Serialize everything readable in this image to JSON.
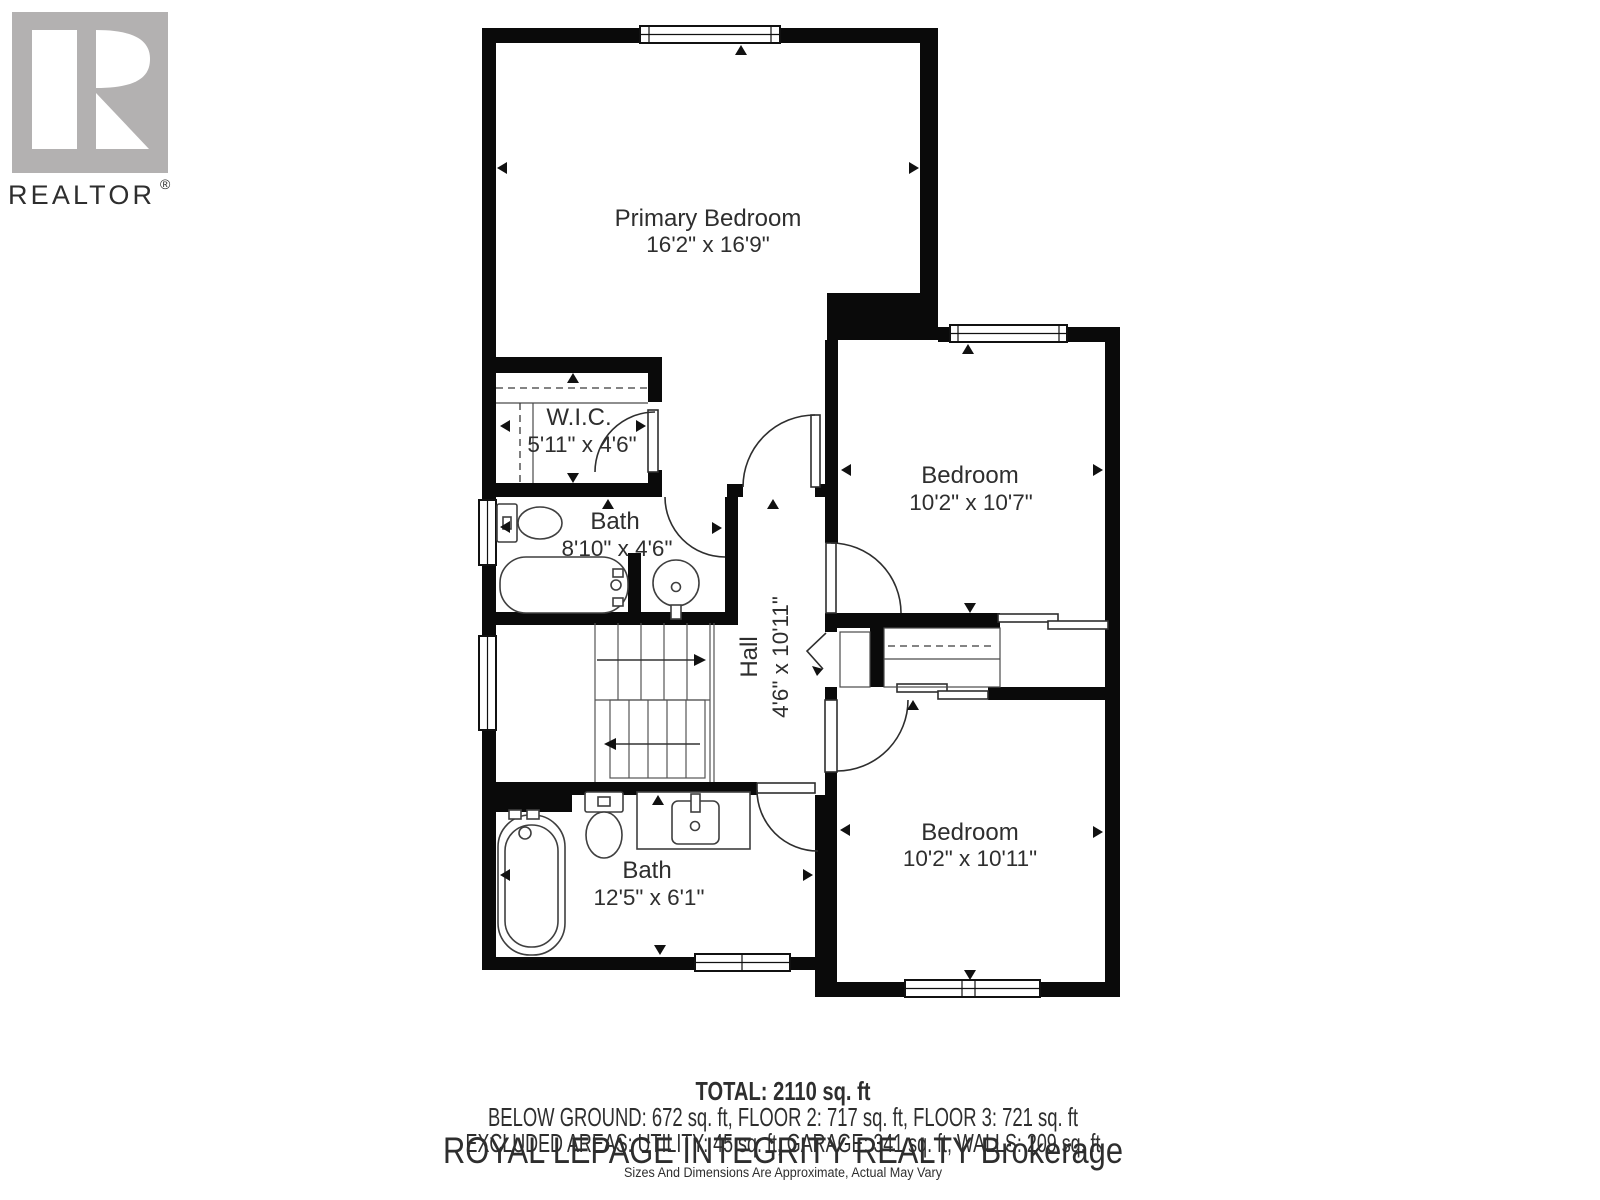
{
  "logo": {
    "brand": "REALTOR",
    "registered": "®",
    "square_color": "#b3b1b1",
    "text_color": "#a8a6a6"
  },
  "rooms": {
    "primary": {
      "name": "Primary Bedroom",
      "dims": "16'2\" x 16'9\""
    },
    "wic": {
      "name": "W.I.C.",
      "dims": "5'11\" x 4'6\""
    },
    "bath_upper": {
      "name": "Bath",
      "dims": "8'10\" x 4'6\""
    },
    "hall": {
      "name": "Hall",
      "dims": "4'6\" x 10'11\""
    },
    "bedroom_top": {
      "name": "Bedroom",
      "dims": "10'2\" x 10'7\""
    },
    "bedroom_bottom": {
      "name": "Bedroom",
      "dims": "10'2\" x 10'11\""
    },
    "bath_lower": {
      "name": "Bath",
      "dims": "12'5\" x 6'1\""
    }
  },
  "footer": {
    "total": "TOTAL: 2110 sq. ft",
    "floors": "BELOW GROUND: 672 sq. ft, FLOOR 2: 717 sq. ft, FLOOR 3: 721 sq. ft",
    "excluded": "EXCLUDED AREAS: UTILITY: 45 sq. ft, GARAGE: 341 sq. ft, WALLS: 209 sq. ft",
    "watermark": "ROYAL LEPAGE INTEGRITY REALTY Brokerage",
    "disclaimer": "Sizes And Dimensions Are Approximate, Actual May Vary"
  },
  "colors": {
    "wall": "#0a0a0a",
    "fixture_stroke": "#3f3f3f",
    "watermark_gray": "#d0d0d0",
    "label_text": "#2e2e2e"
  }
}
